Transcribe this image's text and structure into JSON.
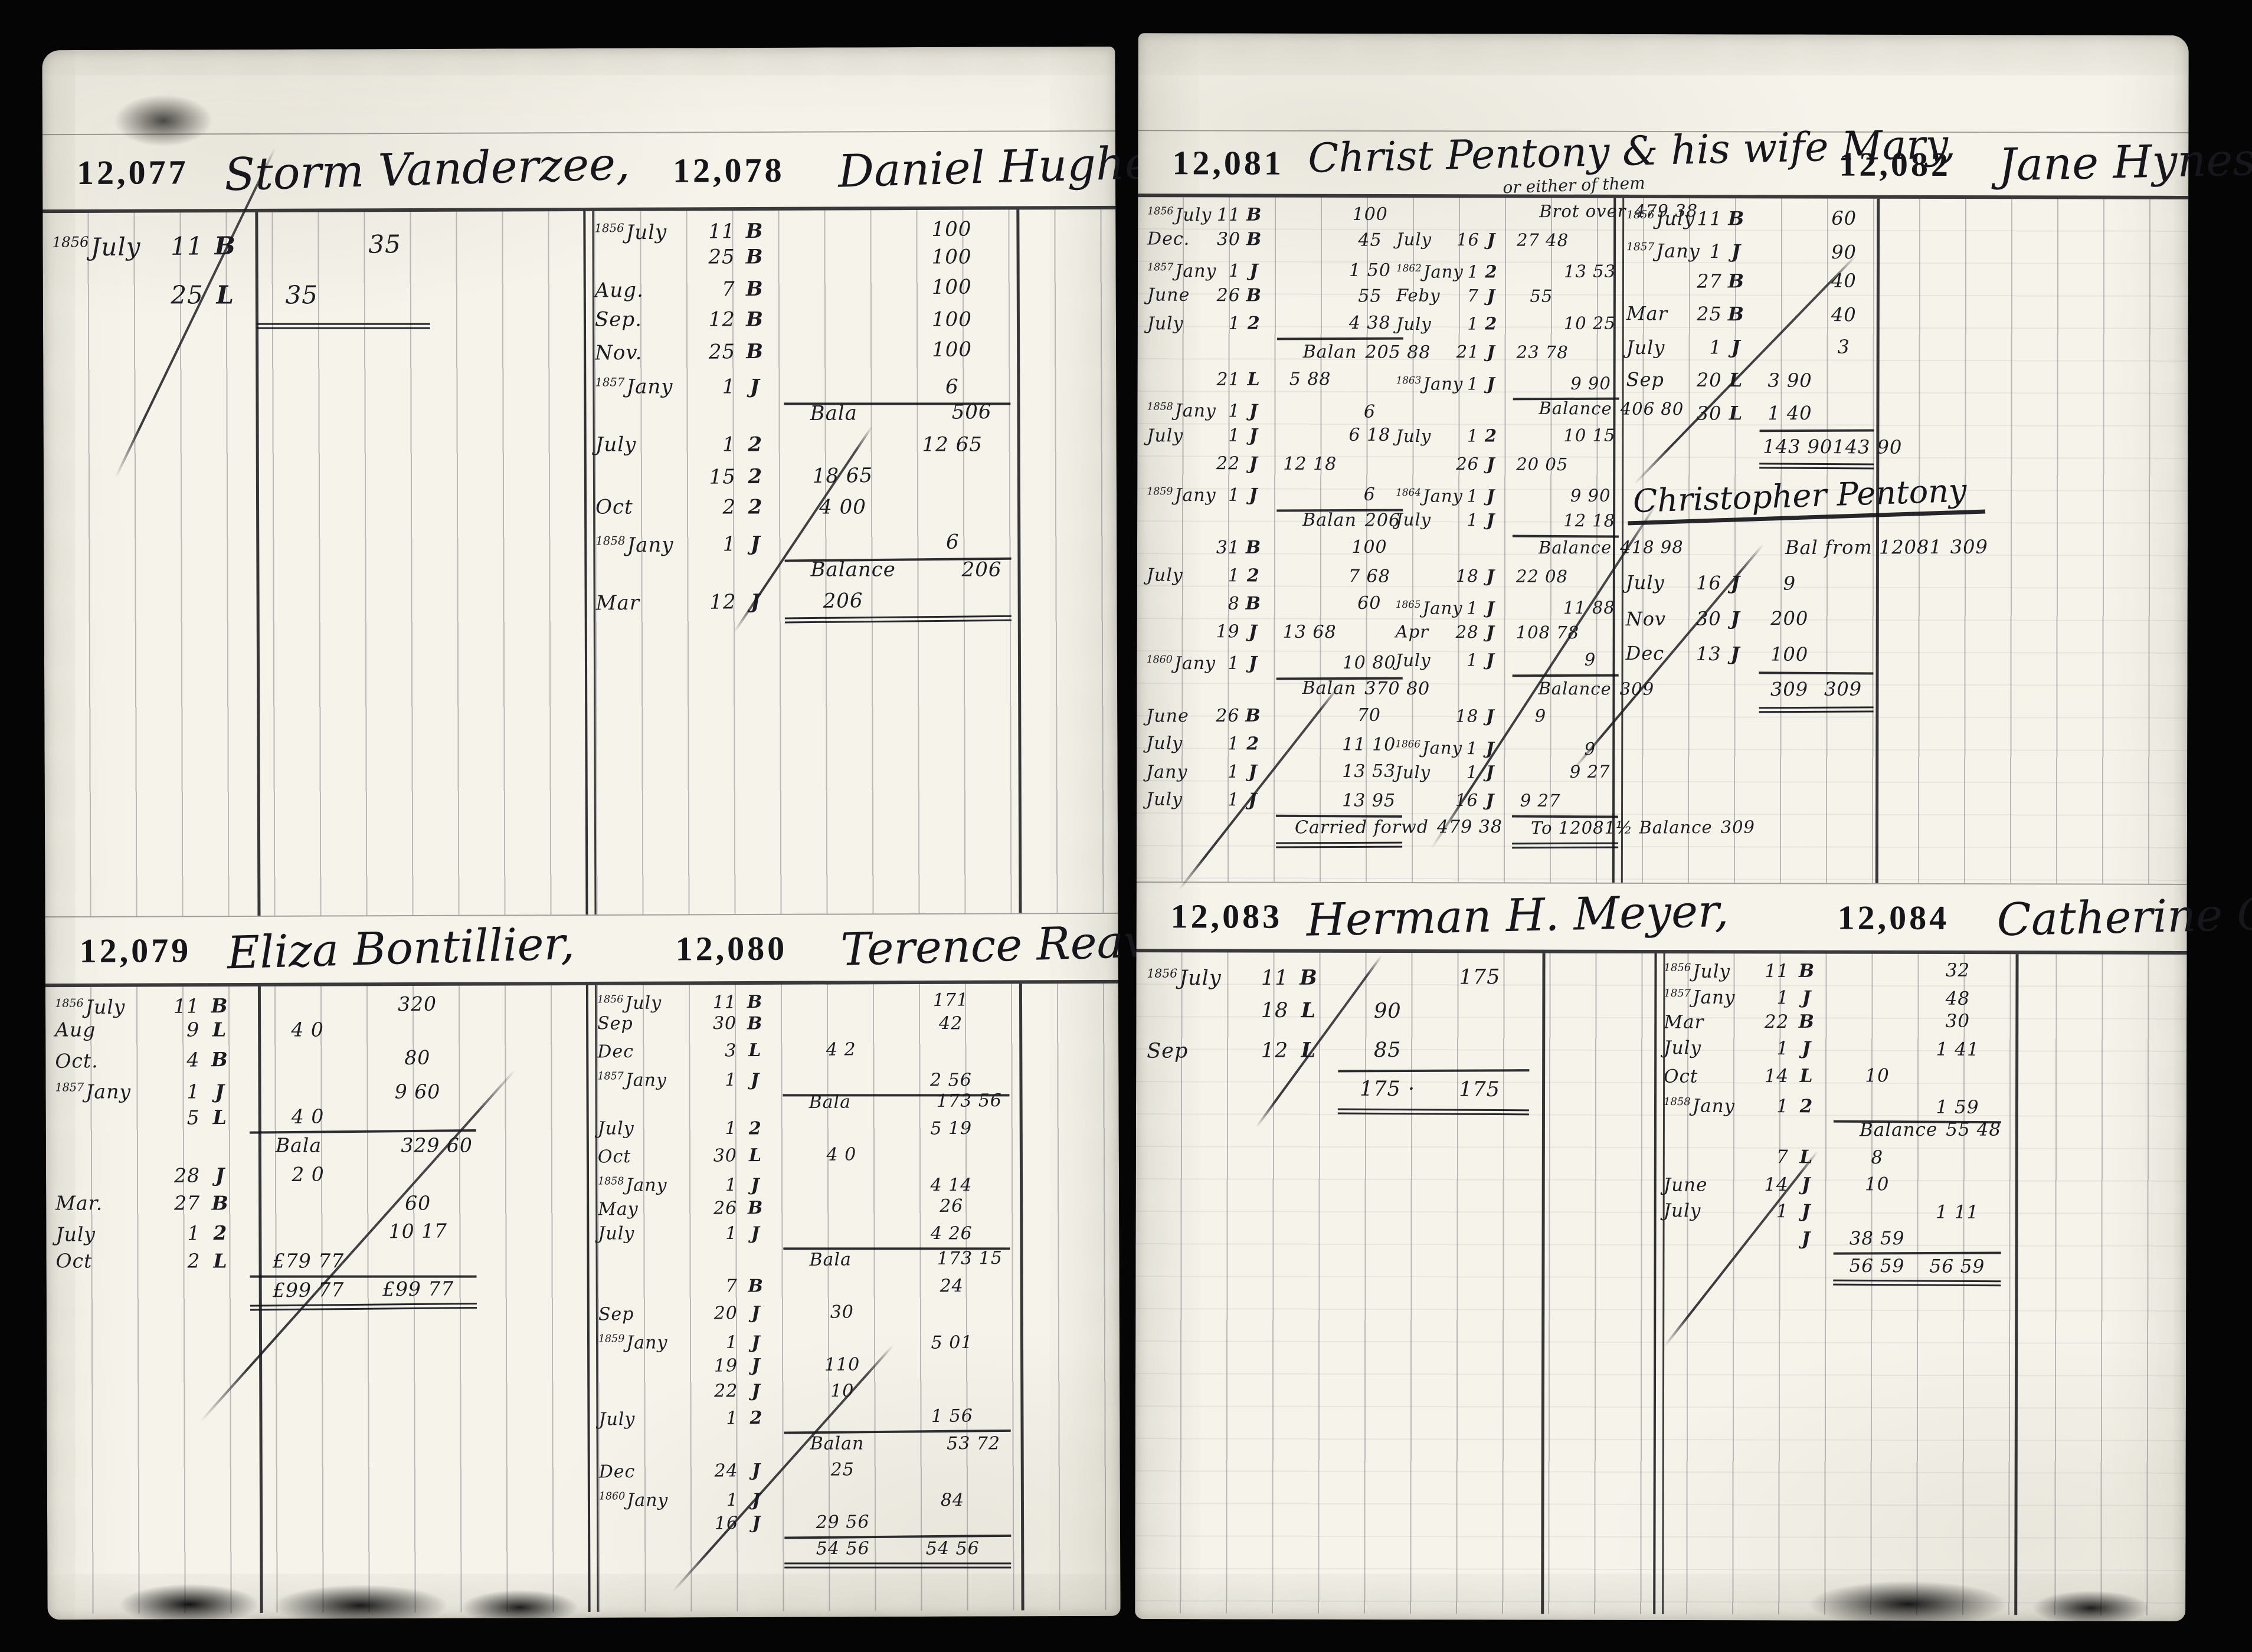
{
  "palette": {
    "paper": "#f5f3ea",
    "ink": "#1d1c22",
    "scan_bg": "#050505"
  },
  "headers": {
    "left_top": [
      {
        "number": "12,077",
        "name": "Storm Vanderzee,"
      },
      {
        "number": "12,078",
        "name": "Daniel Hughes,"
      }
    ],
    "left_bottom": [
      {
        "number": "12,079",
        "name": "Eliza Bontillier,"
      },
      {
        "number": "12,080",
        "name": "Terence Reavey"
      }
    ],
    "right_top": [
      {
        "number": "12,081",
        "name": "Christ Pentony & his wife Mary,",
        "sub": "or either of them"
      },
      {
        "number": "12,082",
        "name": "Jane Hynes."
      }
    ],
    "right_bottom": [
      {
        "number": "12,083",
        "name": "Herman H. Meyer,"
      },
      {
        "number": "12,084",
        "name": "Catherine O'Neill"
      }
    ]
  },
  "accounts": {
    "a12077": {
      "number": "12,077",
      "name": "Storm Vanderzee,",
      "entries": [
        {
          "y": "1856",
          "m": "July",
          "d": "11",
          "r": "B",
          "b": "35"
        },
        {
          "d": "25",
          "r": "L",
          "a": "35",
          "cls": "tot"
        }
      ]
    },
    "a12078": {
      "number": "12,078",
      "name": "Daniel Hughes,",
      "entries": [
        {
          "y": "1856",
          "m": "July",
          "d": "11",
          "r": "B",
          "b": "100"
        },
        {
          "d": "25",
          "r": "B",
          "b": "100"
        },
        {
          "m": "Aug.",
          "d": "7",
          "r": "B",
          "b": "100"
        },
        {
          "m": "Sep.",
          "d": "12",
          "r": "B",
          "b": "100"
        },
        {
          "m": "Nov.",
          "d": "25",
          "r": "B",
          "b": "100"
        },
        {
          "y": "1857",
          "m": "Jany",
          "d": "1",
          "r": "J",
          "b": "6",
          "cls": "ul"
        },
        {
          "label": "Bala",
          "b": "506",
          "cls": "bal"
        },
        {
          "m": "July",
          "d": "1",
          "r": "2",
          "b": "12 65"
        },
        {
          "d": "15",
          "r": "2",
          "a": "18 65"
        },
        {
          "m": "Oct",
          "d": "2",
          "r": "2",
          "a": "4 00"
        },
        {
          "y": "1858",
          "m": "Jany",
          "d": "1",
          "r": "J",
          "b": "6",
          "cls": "ul"
        },
        {
          "label": "Balance",
          "b": "206",
          "cls": "bal"
        },
        {
          "m": "Mar",
          "d": "12",
          "r": "J",
          "a": "206",
          "cls": "tot"
        }
      ]
    },
    "a12079": {
      "number": "12,079",
      "name": "Eliza Bontillier,",
      "entries": [
        {
          "y": "1856",
          "m": "July",
          "d": "11",
          "r": "B",
          "b": "320"
        },
        {
          "m": "Aug",
          "d": "9",
          "r": "L",
          "a": "4 0"
        },
        {
          "m": "Oct.",
          "d": "4",
          "r": "B",
          "b": "80"
        },
        {
          "y": "1857",
          "m": "Jany",
          "d": "1",
          "r": "J",
          "b": "9 60"
        },
        {
          "d": "5",
          "r": "L",
          "a": "4 0",
          "cls": "ul"
        },
        {
          "label": "Bala",
          "b": "329 60",
          "cls": "bal"
        },
        {
          "d": "28",
          "r": "J",
          "a": "2 0"
        },
        {
          "m": "Mar.",
          "d": "27",
          "r": "B",
          "b": "60"
        },
        {
          "m": "July",
          "d": "1",
          "r": "2",
          "b": "10 17"
        },
        {
          "m": "Oct",
          "d": "2",
          "r": "L",
          "a": "£79 77",
          "cls": "ul"
        },
        {
          "a": "£99 77",
          "b": "£99 77",
          "cls": "tot"
        }
      ]
    },
    "a12080": {
      "number": "12,080",
      "name": "Terence Reavey",
      "entries": [
        {
          "y": "1856",
          "m": "July",
          "d": "11",
          "r": "B",
          "b": "171"
        },
        {
          "m": "Sep",
          "d": "30",
          "r": "B",
          "b": "42"
        },
        {
          "m": "Dec",
          "d": "3",
          "r": "L",
          "a": "4 2"
        },
        {
          "y": "1857",
          "m": "Jany",
          "d": "1",
          "r": "J",
          "b": "2 56",
          "cls": "ul"
        },
        {
          "label": "Bala",
          "b": "173 56",
          "cls": "bal"
        },
        {
          "m": "July",
          "d": "1",
          "r": "2",
          "b": "5 19"
        },
        {
          "m": "Oct",
          "d": "30",
          "r": "L",
          "a": "4 0"
        },
        {
          "y": "1858",
          "m": "Jany",
          "d": "1",
          "r": "J",
          "b": "4 14"
        },
        {
          "m": "May",
          "d": "26",
          "r": "B",
          "b": "26"
        },
        {
          "m": "July",
          "d": "1",
          "r": "J",
          "b": "4 26",
          "cls": "ul"
        },
        {
          "label": "Bala",
          "b": "173 15",
          "cls": "bal"
        },
        {
          "d": "7",
          "r": "B",
          "b": "24"
        },
        {
          "m": "Sep",
          "d": "20",
          "r": "J",
          "a": "30"
        },
        {
          "y": "1859",
          "m": "Jany",
          "d": "1",
          "r": "J",
          "b": "5 01"
        },
        {
          "d": "19",
          "r": "J",
          "a": "110"
        },
        {
          "d": "22",
          "r": "J",
          "a": "10"
        },
        {
          "m": "July",
          "d": "1",
          "r": "2",
          "b": "1 56",
          "cls": "ul"
        },
        {
          "label": "Balan",
          "b": "53 72",
          "cls": "bal"
        },
        {
          "m": "Dec",
          "d": "24",
          "r": "J",
          "a": "25"
        },
        {
          "y": "1860",
          "m": "Jany",
          "d": "1",
          "r": "J",
          "b": "84"
        },
        {
          "d": "16",
          "r": "J",
          "a": "29 56",
          "cls": "ul"
        },
        {
          "a": "54 56",
          "b": "54 56",
          "cls": "tot"
        }
      ]
    },
    "a12081": {
      "number": "12,081",
      "name": "Christ Pentony & his wife Mary,",
      "sub": "or either of them",
      "col1": [
        {
          "y": "1856",
          "m": "July",
          "d": "11",
          "r": "B",
          "b": "100"
        },
        {
          "m": "Dec.",
          "d": "30",
          "r": "B",
          "b": "45"
        },
        {
          "y": "1857",
          "m": "Jany",
          "d": "1",
          "r": "J",
          "b": "1 50"
        },
        {
          "m": "June",
          "d": "26",
          "r": "B",
          "b": "55"
        },
        {
          "m": "July",
          "d": "1",
          "r": "2",
          "b": "4 38",
          "cls": "ul"
        },
        {
          "label": "Balan",
          "b": "205 88",
          "cls": "bal"
        },
        {
          "d": "21",
          "r": "L",
          "a": "5 88"
        },
        {
          "y": "1858",
          "m": "Jany",
          "d": "1",
          "r": "J",
          "b": "6"
        },
        {
          "m": "July",
          "d": "1",
          "r": "J",
          "b": "6 18"
        },
        {
          "d": "22",
          "r": "J",
          "a": "12 18"
        },
        {
          "y": "1859",
          "m": "Jany",
          "d": "1",
          "r": "J",
          "b": "6",
          "cls": "ul"
        },
        {
          "label": "Balan",
          "b": "206",
          "cls": "bal"
        },
        {
          "d": "31",
          "r": "B",
          "b": "100"
        },
        {
          "m": "July",
          "d": "1",
          "r": "2",
          "b": "7 68"
        },
        {
          "d": "8",
          "r": "B",
          "b": "60"
        },
        {
          "d": "19",
          "r": "J",
          "a": "13 68"
        },
        {
          "y": "1860",
          "m": "Jany",
          "d": "1",
          "r": "J",
          "b": "10 80",
          "cls": "ul"
        },
        {
          "label": "Balan",
          "b": "370 80",
          "cls": "bal"
        },
        {
          "m": "June",
          "d": "26",
          "r": "B",
          "b": "70"
        },
        {
          "m": "July",
          "d": "1",
          "r": "2",
          "b": "11 10"
        },
        {
          "m": "Jany",
          "d": "1",
          "r": "J",
          "b": "13 53"
        },
        {
          "m": "July",
          "d": "1",
          "r": "J",
          "b": "13 95",
          "cls": "ul"
        },
        {
          "label": "Carried forwd",
          "b": "479 38",
          "cls": "tot"
        }
      ],
      "col2": [
        {
          "label": "Brot over",
          "b": "479 38",
          "cls": "bal"
        },
        {
          "m": "July",
          "d": "16",
          "r": "J",
          "a": "27 48"
        },
        {
          "y": "1862",
          "m": "Jany",
          "d": "1",
          "r": "2",
          "b": "13 53"
        },
        {
          "m": "Feby",
          "d": "7",
          "r": "J",
          "a": "55"
        },
        {
          "m": "July",
          "d": "1",
          "r": "2",
          "b": "10 25"
        },
        {
          "d": "21",
          "r": "J",
          "a": "23 78"
        },
        {
          "y": "1863",
          "m": "Jany",
          "d": "1",
          "r": "J",
          "b": "9 90",
          "cls": "ul"
        },
        {
          "label": "Balance",
          "b": "406 80",
          "cls": "bal"
        },
        {
          "m": "July",
          "d": "1",
          "r": "2",
          "b": "10 15"
        },
        {
          "d": "26",
          "r": "J",
          "a": "20 05"
        },
        {
          "y": "1864",
          "m": "Jany",
          "d": "1",
          "r": "J",
          "b": "9 90"
        },
        {
          "m": "July",
          "d": "1",
          "r": "J",
          "b": "12 18",
          "cls": "ul"
        },
        {
          "label": "Balance",
          "b": "418 98",
          "cls": "bal"
        },
        {
          "d": "18",
          "r": "J",
          "a": "22 08"
        },
        {
          "y": "1865",
          "m": "Jany",
          "d": "1",
          "r": "J",
          "b": "11 88"
        },
        {
          "m": "Apr",
          "d": "28",
          "r": "J",
          "a": "108 78"
        },
        {
          "m": "July",
          "d": "1",
          "r": "J",
          "b": "9",
          "cls": "ul"
        },
        {
          "label": "Balance",
          "b": "309",
          "cls": "bal"
        },
        {
          "d": "18",
          "r": "J",
          "a": "9"
        },
        {
          "y": "1866",
          "m": "Jany",
          "d": "1",
          "r": "J",
          "b": "9"
        },
        {
          "m": "July",
          "d": "1",
          "r": "J",
          "b": "9 27"
        },
        {
          "d": "16",
          "r": "J",
          "a": "9 27",
          "cls": "ul"
        },
        {
          "label": "To 12081½ Balance",
          "b": "309",
          "cls": "tot"
        }
      ]
    },
    "a12082": {
      "number": "12,082",
      "name": "Jane Hynes.",
      "entries": [
        {
          "y": "1856",
          "m": "July",
          "d": "11",
          "r": "B",
          "b": "60"
        },
        {
          "y": "1857",
          "m": "Jany",
          "d": "1",
          "r": "J",
          "b": "90"
        },
        {
          "d": "27",
          "r": "B",
          "b": "40"
        },
        {
          "m": "Mar",
          "d": "25",
          "r": "B",
          "b": "40"
        },
        {
          "m": "July",
          "d": "1",
          "r": "J",
          "b": "3"
        },
        {
          "m": "Sep",
          "d": "20",
          "r": "L",
          "a": "3 90"
        },
        {
          "d": "30",
          "r": "L",
          "a": "1 40",
          "cls": "ul"
        },
        {
          "a": "143 90",
          "b": "143 90",
          "cls": "tot"
        }
      ],
      "transfer": {
        "title": "Christopher Pentony",
        "entries": [
          {
            "label": "Bal from 12081",
            "b": "309",
            "cls": "bal"
          },
          {
            "m": "July",
            "d": "16",
            "r": "J",
            "a": "9"
          },
          {
            "m": "Nov",
            "d": "30",
            "r": "J",
            "a": "200"
          },
          {
            "m": "Dec",
            "d": "13",
            "r": "J",
            "a": "100",
            "cls": "ul"
          },
          {
            "a": "309",
            "b": "309",
            "cls": "tot"
          }
        ]
      }
    },
    "a12083": {
      "number": "12,083",
      "name": "Herman H. Meyer,",
      "entries": [
        {
          "y": "1856",
          "m": "July",
          "d": "11",
          "r": "B",
          "b": "175"
        },
        {
          "d": "18",
          "r": "L",
          "a": "90"
        },
        {
          "m": "Sep",
          "d": "12",
          "r": "L",
          "a": "85",
          "cls": "ul"
        },
        {
          "a": "175 ·",
          "b": "175",
          "cls": "tot"
        }
      ]
    },
    "a12084": {
      "number": "12,084",
      "name": "Catherine O'Neill",
      "entries": [
        {
          "y": "1856",
          "m": "July",
          "d": "11",
          "r": "B",
          "b": "32"
        },
        {
          "y": "1857",
          "m": "Jany",
          "d": "1",
          "r": "J",
          "b": "48"
        },
        {
          "m": "Mar",
          "d": "22",
          "r": "B",
          "b": "30"
        },
        {
          "m": "July",
          "d": "1",
          "r": "J",
          "b": "1 41"
        },
        {
          "m": "Oct",
          "d": "14",
          "r": "L",
          "a": "10"
        },
        {
          "y": "1858",
          "m": "Jany",
          "d": "1",
          "r": "2",
          "b": "1 59",
          "cls": "ul"
        },
        {
          "label": "Balance",
          "b": "55 48",
          "cls": "bal"
        },
        {
          "d": "7",
          "r": "L",
          "a": "8"
        },
        {
          "m": "June",
          "d": "14",
          "r": "J",
          "a": "10"
        },
        {
          "m": "July",
          "d": "1",
          "r": "J",
          "b": "1 11"
        },
        {
          "r": "J",
          "a": "38 59",
          "cls": "ul"
        },
        {
          "a": "56 59",
          "b": "56 59",
          "cls": "tot"
        }
      ]
    }
  }
}
